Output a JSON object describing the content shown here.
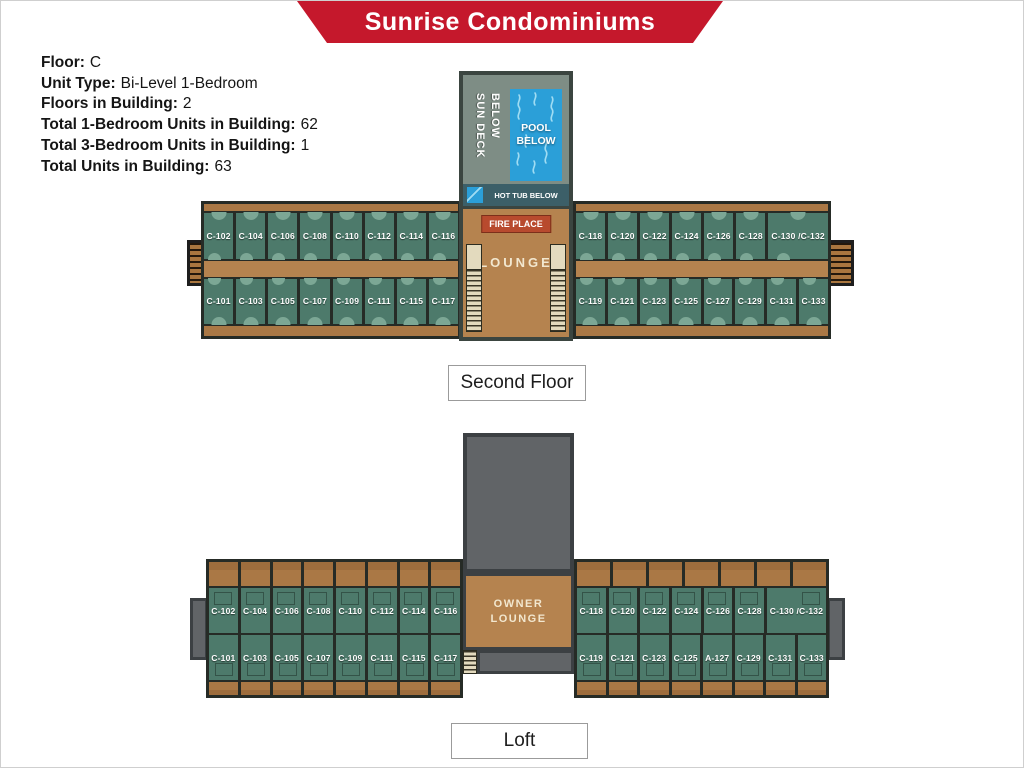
{
  "banner": {
    "title": "Sunrise Condominiums"
  },
  "info": {
    "lines": [
      {
        "label": "Floor:",
        "value": "C"
      },
      {
        "label": "Unit Type:",
        "value": "Bi-Level 1-Bedroom"
      },
      {
        "label": "Floors in Building:",
        "value": "2"
      },
      {
        "label": "Total 1-Bedroom Units in Building:",
        "value": "62"
      },
      {
        "label": "Total 3-Bedroom Units in Building:",
        "value": "1"
      },
      {
        "label": "Total Units in Building:",
        "value": "63"
      }
    ]
  },
  "second_floor": {
    "label": "Second Floor",
    "center": {
      "sun_deck": "SUN DECK BELOW",
      "pool": "POOL BELOW",
      "hot_tub": "HOT TUB BELOW",
      "fireplace": "FIRE PLACE",
      "lounge": "LOUNGE"
    },
    "left_wing": {
      "corridor_labels": [
        "CORRIDOR",
        "CORRIDOR"
      ],
      "top_units": [
        "C-102",
        "C-104",
        "C-106",
        "C-108",
        "C-110",
        "C-112",
        "C-114",
        "C-116"
      ],
      "bottom_units": [
        "C-101",
        "C-103",
        "C-105",
        "C-107",
        "C-109",
        "C-111",
        "C-115",
        "C-117"
      ]
    },
    "right_wing": {
      "corridor_labels": [
        "CORRIDOR",
        "CORRIDOR"
      ],
      "top_units": [
        "C-118",
        "C-120",
        "C-122",
        "C-124",
        "C-126",
        "C-128",
        "C-130 /C-132"
      ],
      "bottom_units": [
        "C-119",
        "C-121",
        "C-123",
        "C-125",
        "C-127",
        "C-129",
        "C-131",
        "C-133"
      ]
    }
  },
  "loft": {
    "label": "Loft",
    "center": {
      "owner_lounge": "OWNER LOUNGE"
    },
    "left_wing": {
      "top_units": [
        "C-102",
        "C-104",
        "C-106",
        "C-108",
        "C-110",
        "C-112",
        "C-114",
        "C-116"
      ],
      "bottom_units": [
        "C-101",
        "C-103",
        "C-105",
        "C-107",
        "C-109",
        "C-111",
        "C-115",
        "C-117"
      ]
    },
    "right_wing": {
      "top_units": [
        "C-118",
        "C-120",
        "C-122",
        "C-124",
        "C-126",
        "C-128",
        "C-130 /C-132"
      ],
      "bottom_units": [
        "C-119",
        "C-121",
        "C-123",
        "C-125",
        "A-127",
        "C-129",
        "C-131",
        "C-133"
      ]
    }
  },
  "colors": {
    "banner-red": "#c5182c",
    "unit-green": "#4d7a6b",
    "wood-brown": "#b5834f",
    "balcony-brown": "#aa7845",
    "pool-blue": "#2b9fd8",
    "fireplace-red": "#b84a2e",
    "deck-gray": "#7e8d85",
    "loft-gray": "#616467",
    "line-dark": "#262b26"
  }
}
